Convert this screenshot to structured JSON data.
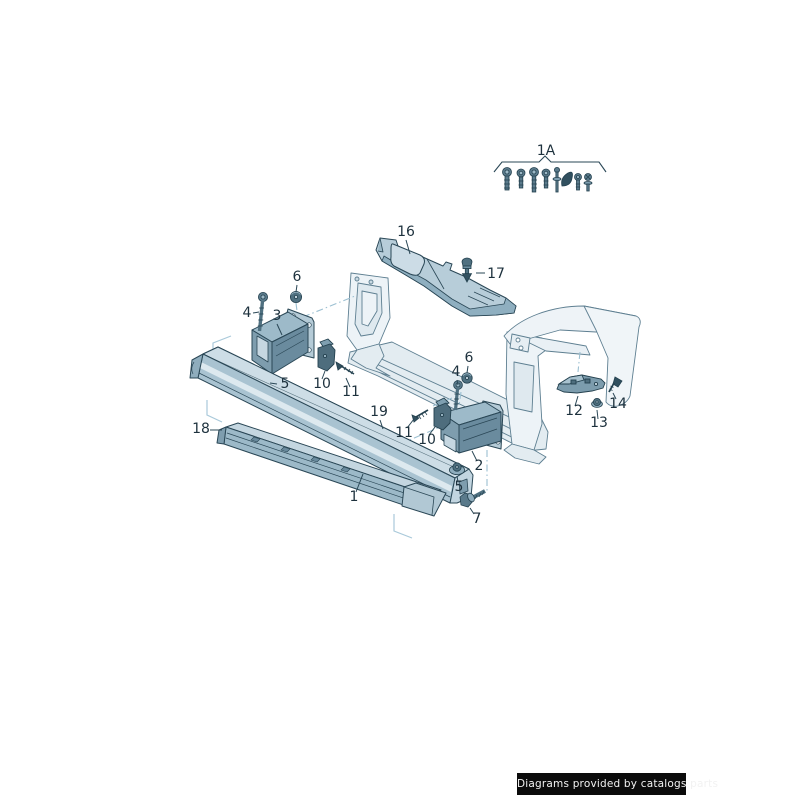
{
  "page": {
    "background": "#ffffff"
  },
  "watermark": {
    "text": "Diagrams provided by catalogs parts",
    "bg": "#0b0b0b",
    "fg": "#f2f2f2"
  },
  "colors": {
    "line": "#2a4756",
    "line_light": "#5e7f91",
    "fill_lightest": "#edf3f7",
    "fill_light": "#d3e0e8",
    "fill_mid": "#b5cbd7",
    "fill_shade": "#8fadbd",
    "fill_dark": "#6d8fa1",
    "hardware_dark": "#4f7080",
    "hardware_darkest": "#31505f",
    "construction_blue": "#9cc0d2",
    "corner_blue": "#a9c9da",
    "label": "#1d313d"
  },
  "diagram": {
    "fastener_kit": {
      "label": "1A",
      "items": [
        "bolt-large-icon",
        "bolt-medium-icon",
        "bolt-long-icon",
        "bolt-medium-icon",
        "screw-thin-icon",
        "clip-dark-icon",
        "bolt-small-icon",
        "screw-star-icon"
      ]
    },
    "callouts": [
      {
        "id": "1A",
        "text": "1A",
        "x": 546,
        "y": 155,
        "leader": null
      },
      {
        "id": "16",
        "text": "16",
        "x": 406,
        "y": 236,
        "leader": [
          406,
          240,
          410,
          254
        ]
      },
      {
        "id": "17",
        "text": "17",
        "x": 496,
        "y": 278,
        "leader": [
          485,
          273,
          476,
          273
        ]
      },
      {
        "id": "6L",
        "text": "6",
        "x": 297,
        "y": 281,
        "leader": [
          297,
          285,
          296,
          292
        ]
      },
      {
        "id": "4L",
        "text": "4",
        "x": 247,
        "y": 317,
        "leader": [
          253,
          313,
          259,
          312
        ]
      },
      {
        "id": "3",
        "text": "3",
        "x": 277,
        "y": 320,
        "leader": [
          277,
          324,
          282,
          335
        ]
      },
      {
        "id": "5L",
        "text": "5",
        "x": 285,
        "y": 388,
        "leader": [
          277,
          384,
          270,
          383
        ]
      },
      {
        "id": "10L",
        "text": "10",
        "x": 322,
        "y": 388,
        "leader": [
          322,
          379,
          325,
          371
        ]
      },
      {
        "id": "11L",
        "text": "11",
        "x": 351,
        "y": 396,
        "leader": [
          350,
          387,
          346,
          378
        ]
      },
      {
        "id": "19",
        "text": "19",
        "x": 379,
        "y": 416,
        "leader": [
          380,
          420,
          383,
          429
        ]
      },
      {
        "id": "11R",
        "text": "11",
        "x": 404,
        "y": 437,
        "leader": [
          407,
          428,
          414,
          419
        ]
      },
      {
        "id": "10R",
        "text": "10",
        "x": 427,
        "y": 444,
        "leader": [
          429,
          435,
          435,
          427
        ]
      },
      {
        "id": "6R",
        "text": "6",
        "x": 469,
        "y": 362,
        "leader": [
          468,
          366,
          467,
          373
        ]
      },
      {
        "id": "4R",
        "text": "4",
        "x": 456,
        "y": 376,
        "leader": [
          457,
          380,
          458,
          385
        ]
      },
      {
        "id": "2",
        "text": "2",
        "x": 479,
        "y": 470,
        "leader": [
          477,
          461,
          472,
          451
        ]
      },
      {
        "id": "5R",
        "text": "5",
        "x": 459,
        "y": 491,
        "leader": [
          458,
          482,
          457,
          476
        ]
      },
      {
        "id": "7",
        "text": "7",
        "x": 477,
        "y": 523,
        "leader": [
          474,
          514,
          470,
          508
        ]
      },
      {
        "id": "1",
        "text": "1",
        "x": 354,
        "y": 501,
        "leader": [
          356,
          492,
          363,
          474
        ]
      },
      {
        "id": "18",
        "text": "18",
        "x": 201,
        "y": 433,
        "leader": [
          210,
          430,
          222,
          430
        ]
      },
      {
        "id": "12",
        "text": "12",
        "x": 574,
        "y": 415,
        "leader": [
          575,
          406,
          578,
          396
        ]
      },
      {
        "id": "13",
        "text": "13",
        "x": 599,
        "y": 427,
        "leader": [
          598,
          419,
          597,
          410
        ]
      },
      {
        "id": "14",
        "text": "14",
        "x": 618,
        "y": 408,
        "leader": [
          616,
          399,
          613,
          393
        ]
      }
    ]
  }
}
